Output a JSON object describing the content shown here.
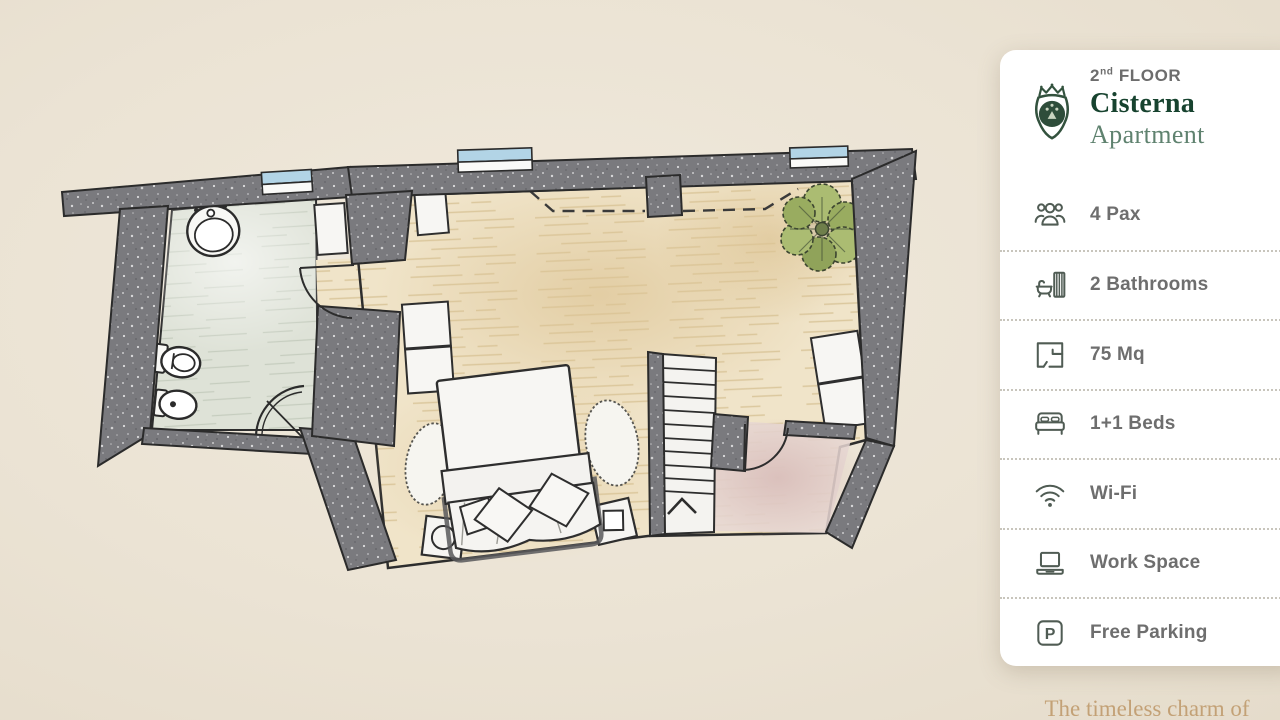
{
  "card": {
    "floor_number": "2",
    "floor_suffix": "nd",
    "floor_word": "FLOOR",
    "name": "Cisterna",
    "subtitle": "Apartment",
    "crest_icon": "heraldic-crest-icon",
    "amenities": [
      {
        "icon": "people-group-icon",
        "label": "4 Pax"
      },
      {
        "icon": "bathtub-shower-icon",
        "label": "2 Bathrooms"
      },
      {
        "icon": "floor-plan-icon",
        "label": "75 Mq"
      },
      {
        "icon": "double-bed-icon",
        "label": "1+1 Beds"
      },
      {
        "icon": "wifi-icon",
        "label": "Wi-Fi"
      },
      {
        "icon": "laptop-icon",
        "label": "Work Space"
      },
      {
        "icon": "parking-icon",
        "label": "Free Parking",
        "glyph": "P"
      }
    ]
  },
  "footer": {
    "tagline": "The timeless charm of"
  },
  "floorplan": {
    "type": "apartment-floor-plan",
    "rooms": [
      "bathroom",
      "bedroom-living",
      "hallway",
      "staircase"
    ],
    "stairs_direction": "up",
    "features": [
      "double-bed",
      "wardrobe",
      "corner-shower",
      "sink",
      "toilet",
      "bidet",
      "plant",
      "3-windows"
    ],
    "colors": {
      "background": "#ece5d7",
      "wall": "#7a7a7e",
      "wood_floor": "#f0e4c9",
      "tile_floor": "#dee2d7",
      "hallway_floor": "#e6d7d3",
      "window_glass": "#b2d4e6",
      "plant_green": "#a4b56c",
      "accent_green": "#17432f",
      "tagline_gold": "#c3a176"
    }
  }
}
